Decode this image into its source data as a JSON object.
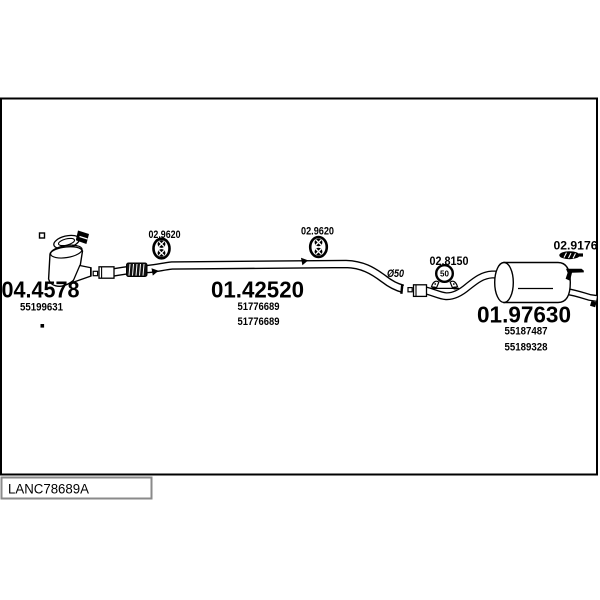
{
  "page": {
    "background": "#ffffff",
    "line_color": "#000000",
    "footer_box_border": "#8a8a8a"
  },
  "diagram": {
    "pipe_diameter_label": "Ø50",
    "parts": {
      "catalyst": {
        "code": "04.4578",
        "oe_refs": [
          "55199631"
        ]
      },
      "centre_pipe": {
        "code": "01.42520",
        "oe_refs": [
          "51776689",
          "51776689"
        ]
      },
      "rear_silencer": {
        "code": "01.97630",
        "oe_refs": [
          "55187487",
          "55189328"
        ]
      }
    },
    "fittings": {
      "hanger_left": {
        "code": "02.9620",
        "type": "rubber-hanger"
      },
      "hanger_right": {
        "code": "02.9620",
        "type": "rubber-hanger"
      },
      "clamp": {
        "code": "02.8150",
        "size": "50",
        "type": "clamp"
      },
      "strap": {
        "code": "02.9176",
        "type": "rubber-strap"
      }
    }
  },
  "footer": {
    "code": "LANC78689A"
  }
}
